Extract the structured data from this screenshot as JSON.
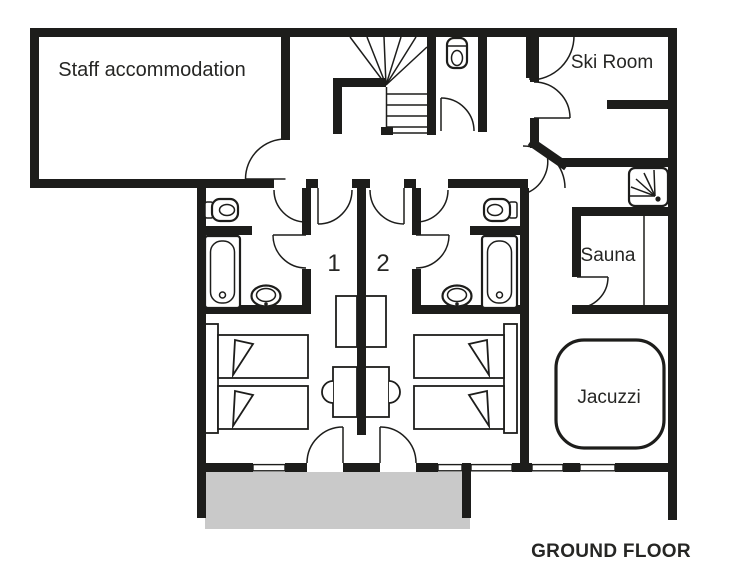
{
  "floor": {
    "label": "GROUND FLOOR"
  },
  "rooms": {
    "staff_accommodation": {
      "label": "Staff accommodation"
    },
    "ski_room": {
      "label": "Ski Room"
    },
    "sauna": {
      "label": "Sauna"
    },
    "jacuzzi": {
      "label": "Jacuzzi"
    },
    "bedroom_1": {
      "number": "1"
    },
    "bedroom_2": {
      "number": "2"
    }
  },
  "colors": {
    "wall": "#1d1d1b",
    "terrace": "#c9c9c9",
    "background": "#ffffff"
  },
  "fixtures": [
    "staircase",
    "toilet",
    "bathtub",
    "washbasin",
    "shower",
    "sauna-bench",
    "jacuzzi-tub",
    "single-bed",
    "wardrobe",
    "desk-with-chair",
    "terrace",
    "door",
    "window"
  ]
}
